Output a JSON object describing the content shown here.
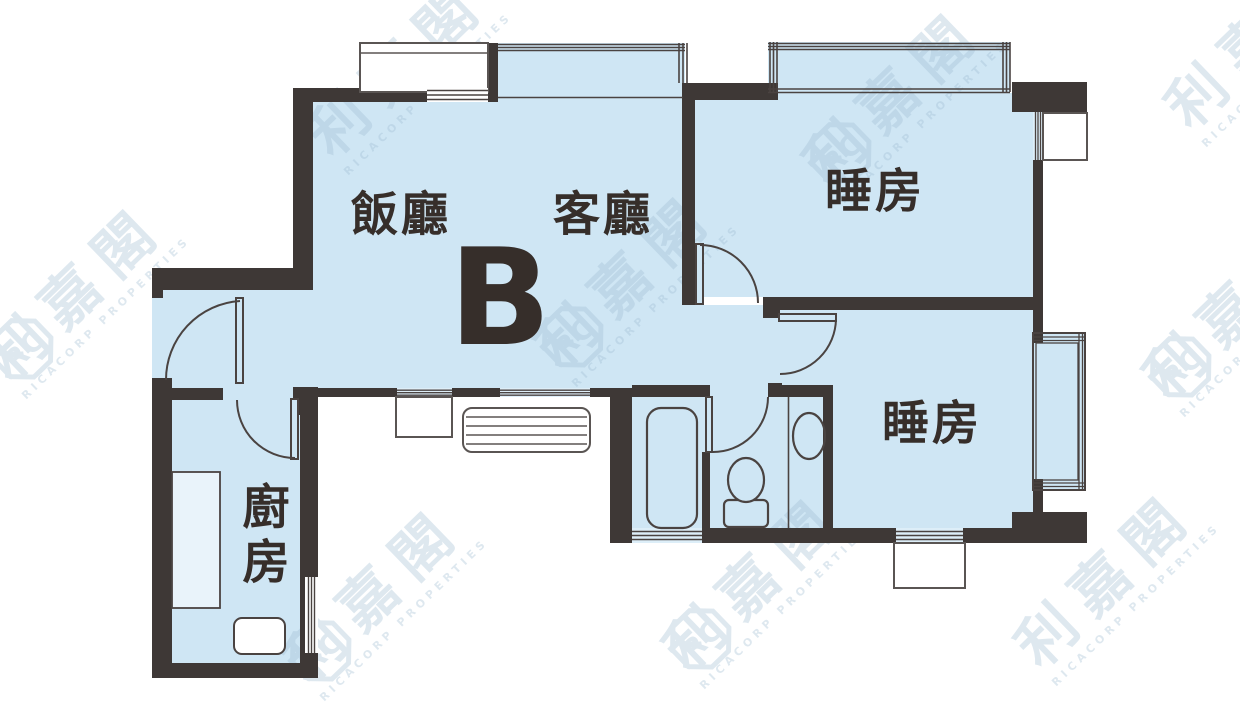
{
  "floor_plan": {
    "unit_label": "B",
    "rooms": {
      "dining": "飯廳",
      "living": "客廳",
      "bedroom_upper": "睡房",
      "bedroom_lower": "睡房",
      "kitchen": "廚房"
    },
    "colors": {
      "floor_fill": "#cfe6f4",
      "wall": "#3e3836",
      "outline": "#4a4341",
      "label_text": "#362e2a",
      "watermark": "#9fbdd3"
    }
  },
  "watermark": {
    "name": "利嘉閣",
    "company": "RICACORP PROPERTIES",
    "monogram": "RC"
  }
}
